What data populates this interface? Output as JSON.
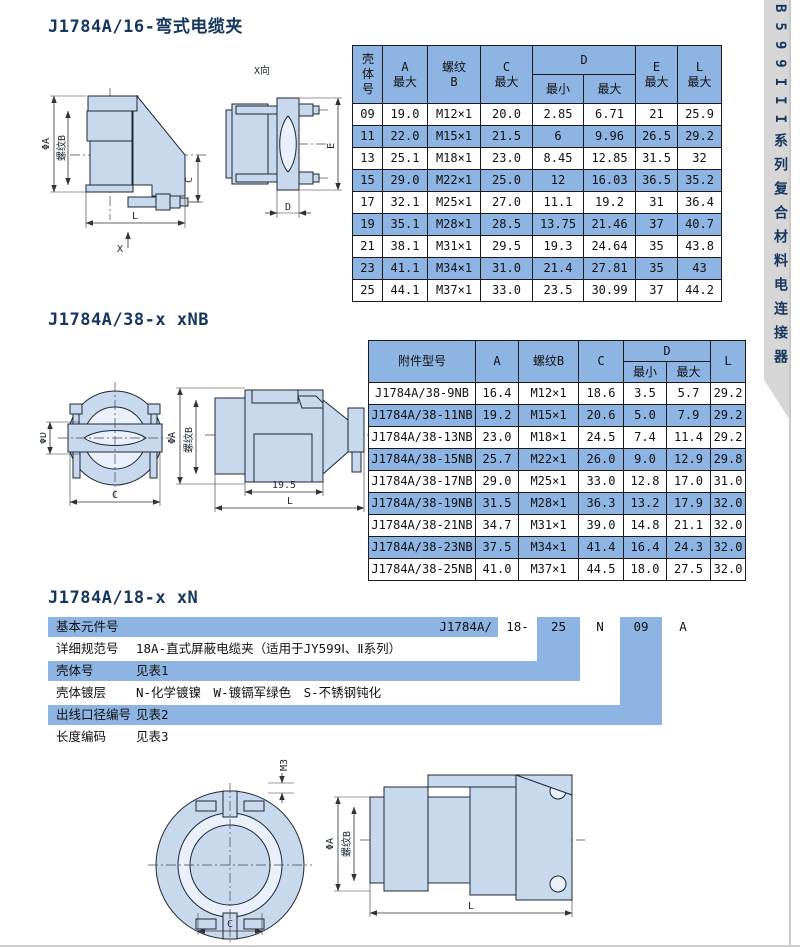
{
  "side_tab": {
    "label": "B599III系列复合材料电连接器"
  },
  "section1": {
    "title": "J1784A/16-弯式电缆夹",
    "drawing": {
      "view": "X向",
      "phiA": "ΦA",
      "thread": "螺纹B",
      "c": "C",
      "l": "L",
      "x": "X",
      "e": "E",
      "d": "D"
    },
    "table": {
      "header": {
        "shell": "壳体号",
        "a": {
          "main": "A",
          "sub": "最大"
        },
        "thread": {
          "main": "螺纹",
          "sub": "B"
        },
        "c": {
          "main": "C",
          "sub": "最大"
        },
        "d": "D",
        "dmin": "最小",
        "dmax": "最大",
        "e": {
          "main": "E",
          "sub": "最大"
        },
        "l": {
          "main": "L",
          "sub": "最大"
        }
      },
      "rows": [
        [
          "09",
          "19.0",
          "M12×1",
          "20.0",
          "2.85",
          "6.71",
          "21",
          "25.9"
        ],
        [
          "11",
          "22.0",
          "M15×1",
          "21.5",
          "6",
          "9.96",
          "26.5",
          "29.2"
        ],
        [
          "13",
          "25.1",
          "M18×1",
          "23.0",
          "8.45",
          "12.85",
          "31.5",
          "32"
        ],
        [
          "15",
          "29.0",
          "M22×1",
          "25.0",
          "12",
          "16.03",
          "36.5",
          "35.2"
        ],
        [
          "17",
          "32.1",
          "M25×1",
          "27.0",
          "11.1",
          "19.2",
          "31",
          "36.4"
        ],
        [
          "19",
          "35.1",
          "M28×1",
          "28.5",
          "13.75",
          "21.46",
          "37",
          "40.7"
        ],
        [
          "21",
          "38.1",
          "M31×1",
          "29.5",
          "19.3",
          "24.64",
          "35",
          "43.8"
        ],
        [
          "23",
          "41.1",
          "M34×1",
          "31.0",
          "21.4",
          "27.81",
          "35",
          "43"
        ],
        [
          "25",
          "44.1",
          "M37×1",
          "33.0",
          "23.5",
          "30.99",
          "37",
          "44.2"
        ]
      ]
    }
  },
  "section2": {
    "title": "J1784A/38-x xNB",
    "drawing": {
      "phiD": "ΦD",
      "c": "C",
      "phiA": "ΦA",
      "thread": "螺纹B",
      "len195": "19.5",
      "l": "L"
    },
    "table": {
      "header": {
        "model": "附件型号",
        "a": "A",
        "thread": "螺纹B",
        "c": "C",
        "d": "D",
        "dmin": "最小",
        "dmax": "最大",
        "l": "L"
      },
      "rows": [
        [
          "J1784A/38-9NB",
          "16.4",
          "M12×1",
          "18.6",
          "3.5",
          "5.7",
          "29.2"
        ],
        [
          "J1784A/38-11NB",
          "19.2",
          "M15×1",
          "20.6",
          "5.0",
          "7.9",
          "29.2"
        ],
        [
          "J1784A/38-13NB",
          "23.0",
          "M18×1",
          "24.5",
          "7.4",
          "11.4",
          "29.2"
        ],
        [
          "J1784A/38-15NB",
          "25.7",
          "M22×1",
          "26.0",
          "9.0",
          "12.9",
          "29.8"
        ],
        [
          "J1784A/38-17NB",
          "29.0",
          "M25×1",
          "33.0",
          "12.8",
          "17.0",
          "31.0"
        ],
        [
          "J1784A/38-19NB",
          "31.5",
          "M28×1",
          "36.3",
          "13.2",
          "17.9",
          "32.0"
        ],
        [
          "J1784A/38-21NB",
          "34.7",
          "M31×1",
          "39.0",
          "14.8",
          "21.1",
          "32.0"
        ],
        [
          "J1784A/38-23NB",
          "37.5",
          "M34×1",
          "41.4",
          "16.4",
          "24.3",
          "32.0"
        ],
        [
          "J1784A/38-25NB",
          "41.0",
          "M37×1",
          "44.5",
          "18.0",
          "27.5",
          "32.0"
        ]
      ]
    }
  },
  "section3": {
    "title": "J1784A/18-x xN",
    "drawing": {
      "m3": "M3",
      "c": "C",
      "phiA": "ΦA",
      "thread": "螺纹B",
      "l": "L"
    },
    "breakdown": {
      "rows": [
        {
          "label": "基本元件号",
          "desc": ""
        },
        {
          "label": "详细规范号",
          "desc": "18A-直式屏蔽电缆夹（适用于JY599Ⅰ、Ⅱ系列）"
        },
        {
          "label": "壳体号",
          "desc": "见表1"
        },
        {
          "label": "壳体镀层",
          "desc": "N-化学镀镍　W-镀镉军绿色　S-不锈钢钝化"
        },
        {
          "label": "出线口径编号",
          "desc": "见表2"
        },
        {
          "label": "长度编码",
          "desc": "见表3"
        }
      ],
      "code": {
        "prefix": "J1784A/",
        "seg1": "18-",
        "seg2": "25",
        "seg3": "N",
        "seg4": "09",
        "seg5": "A"
      }
    }
  },
  "colors": {
    "highlight_blue": "#8db4e2",
    "title_navy": "#17365d",
    "drawing_fill": "#c8d9ee",
    "tab_gray": "#d6d6d6"
  }
}
